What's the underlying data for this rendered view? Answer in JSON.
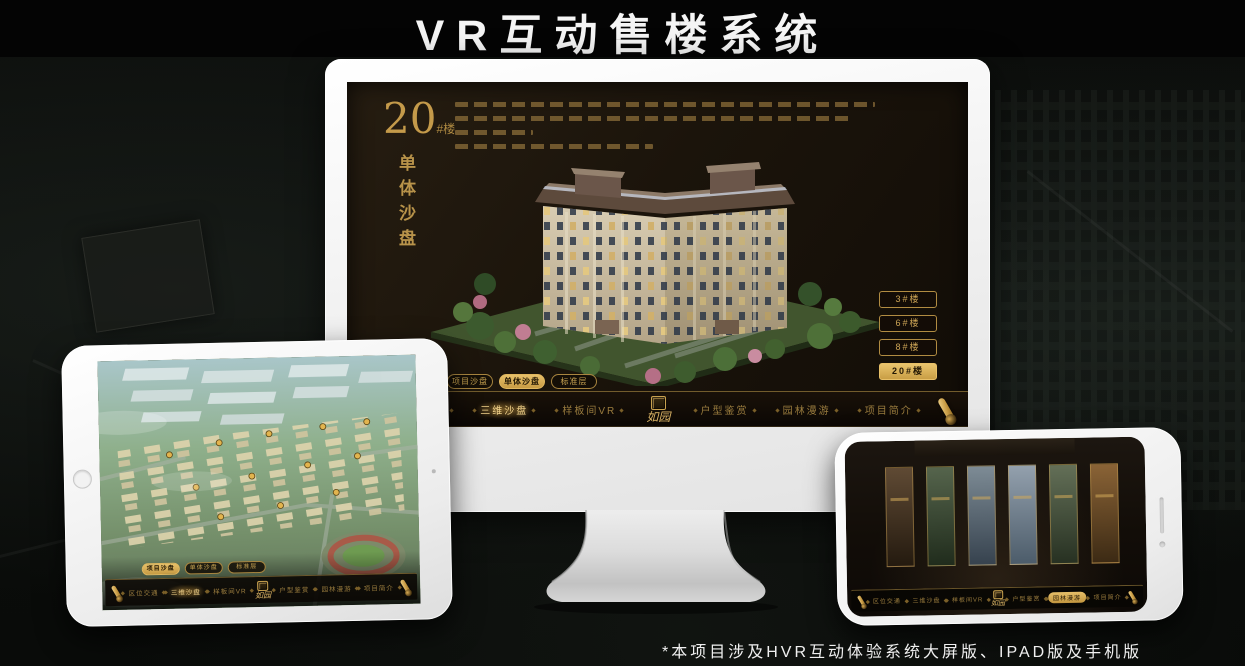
{
  "page": {
    "title": "VR互动售楼系统",
    "footnote": "*本项目涉及HVR互动体验系统大屏版、IPAD版及手机版"
  },
  "colors": {
    "gold": "#C9A24F",
    "gold_bright": "#E9C46D",
    "selected_text": "#241804",
    "screen_bg": "#1B140B",
    "nav_bg": "#0B0704",
    "frame_white": "#F4F4F4"
  },
  "icons": {
    "nav_end": "scroll-icon",
    "brand": "seal-icon",
    "tablet": "home-button-icon",
    "phone": "camera-dot-icon"
  },
  "brand": {
    "logo_text": "如园"
  },
  "monitor": {
    "heading_number": "20",
    "heading_unit": "#楼",
    "heading_subtitle": "单体沙盘",
    "floor_buttons": [
      {
        "label": "3#楼",
        "selected": false
      },
      {
        "label": "6#楼",
        "selected": false
      },
      {
        "label": "8#楼",
        "selected": false
      },
      {
        "label": "20#楼",
        "selected": true
      }
    ],
    "sub_tabs": [
      {
        "label": "项目沙盘",
        "selected": false
      },
      {
        "label": "单体沙盘",
        "selected": true
      },
      {
        "label": "标准层",
        "selected": false
      }
    ],
    "nav_items": [
      {
        "label": "区位交通",
        "selected": false
      },
      {
        "label": "三维沙盘",
        "selected": true
      },
      {
        "label": "样板间VR",
        "selected": false
      },
      {
        "label": "户型鉴赏",
        "selected": false
      },
      {
        "label": "园林漫游",
        "selected": false
      },
      {
        "label": "项目简介",
        "selected": false
      }
    ]
  },
  "tablet": {
    "sub_tabs": [
      {
        "label": "项目沙盘",
        "selected": true
      },
      {
        "label": "单体沙盘",
        "selected": false
      },
      {
        "label": "标准层",
        "selected": false
      }
    ],
    "nav_items": [
      {
        "label": "区位交通",
        "selected": false
      },
      {
        "label": "三维沙盘",
        "selected": true
      },
      {
        "label": "样板间VR",
        "selected": false
      },
      {
        "label": "户型鉴赏",
        "selected": false
      },
      {
        "label": "园林漫游",
        "selected": false
      },
      {
        "label": "项目简介",
        "selected": false
      }
    ]
  },
  "phone": {
    "nav_items": [
      {
        "label": "区位交通",
        "selected": false
      },
      {
        "label": "三维沙盘",
        "selected": false
      },
      {
        "label": "样板间VR",
        "selected": false
      },
      {
        "label": "户型鉴赏",
        "selected": false
      },
      {
        "label": "园林漫游",
        "selected": true
      },
      {
        "label": "项目简介",
        "selected": false
      }
    ]
  }
}
